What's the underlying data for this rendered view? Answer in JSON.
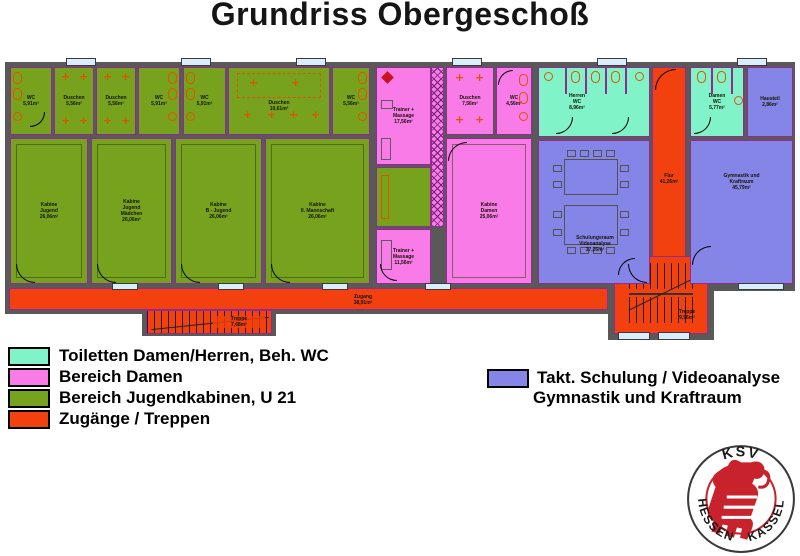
{
  "title": "Grundriss Obergeschoß",
  "colors": {
    "toiletten": "#80f4c8",
    "damen": "#f87be8",
    "jugend": "#76a21e",
    "zugaenge": "#f2400f",
    "schulung": "#8585e8",
    "wall": "#595959"
  },
  "icons": {
    "shower_cross": "+"
  },
  "rooms": {
    "wc_a": "WC\n5,91m²",
    "dusche_a": "Duschen\n5,56m²",
    "dusche_b": "Duschen\n5,56m²",
    "wc_b": "WC\n5,91m²",
    "wc_c": "WC\n5,91m²",
    "dusche_c": "Duschen\n10,61m²",
    "wc_d": "WC\n5,56m²",
    "kabine1": "Kabine\nJugend\n26,06m²",
    "kabine2": "Kabine\nJugend\nMädchen\n26,06m²",
    "kabine3": "Kabine\nB - Jugend\n26,06m²",
    "kabine4": "Kabine\nII. Mannschaft\n26,06m²",
    "trainer1": "Trainer +\nMassage\n17,56m²",
    "trainer2": "Trainer +\nMassage\n11,56m²",
    "duschen_damen": "Duschen\n7,56m²",
    "wc_damen_bereich": "WC\n4,56m²",
    "kabine_damen": "Kabine\nDamen\n25,06m²",
    "herren_wc": "Herren\nWC\n8,96m²",
    "damen_wc": "Damen\nWC\n5,77m²",
    "hausteil": "Hausteil\n2,86m²",
    "schulungsraum": "Schulungsraum\nVideoanalyse\n37,26m²",
    "gymnastik": "Gymnastik und\nKraftraum\n45,79m²",
    "flur": "Flur\n41,26m²",
    "zugang": "Zugang\n38,91m²",
    "treppe1": "Treppe\n7,68m²",
    "treppe2": "Treppe\n9,96m²"
  },
  "dims": {
    "stair_width": "1,06 m"
  },
  "legend": {
    "left": [
      {
        "label": "Toiletten Damen/Herren, Beh. WC"
      },
      {
        "label": "Bereich Damen"
      },
      {
        "label": "Bereich Jugendkabinen, U 21"
      },
      {
        "label": "Zugänge / Treppen"
      }
    ],
    "right": {
      "line1": "Takt. Schulung / Videoanalyse",
      "line2": "Gymnastik und Kraftraum"
    }
  },
  "logo": {
    "top": "KSV",
    "bottom_left": "HESSEN",
    "bottom_right": "KASSEL"
  }
}
